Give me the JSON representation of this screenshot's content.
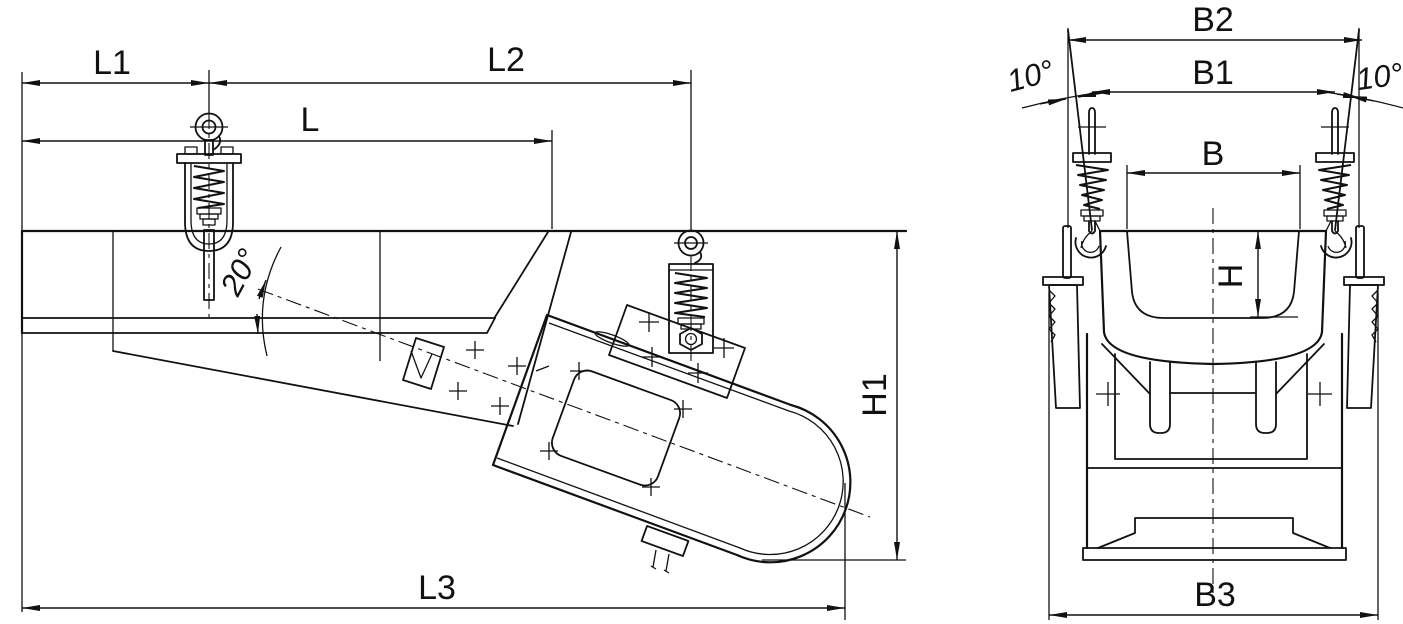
{
  "drawing": {
    "background": "#ffffff",
    "line_color": "#111111",
    "side_view": {
      "dims": {
        "l1": "L1",
        "l2": "L2",
        "l": "L",
        "l3": "L3",
        "h1": "H1",
        "angle": "20°"
      }
    },
    "end_view": {
      "dims": {
        "b2": "B2",
        "b1": "B1",
        "b": "B",
        "b3": "B3",
        "h": "H",
        "angle_left": "10°",
        "angle_right": "10°"
      }
    }
  }
}
